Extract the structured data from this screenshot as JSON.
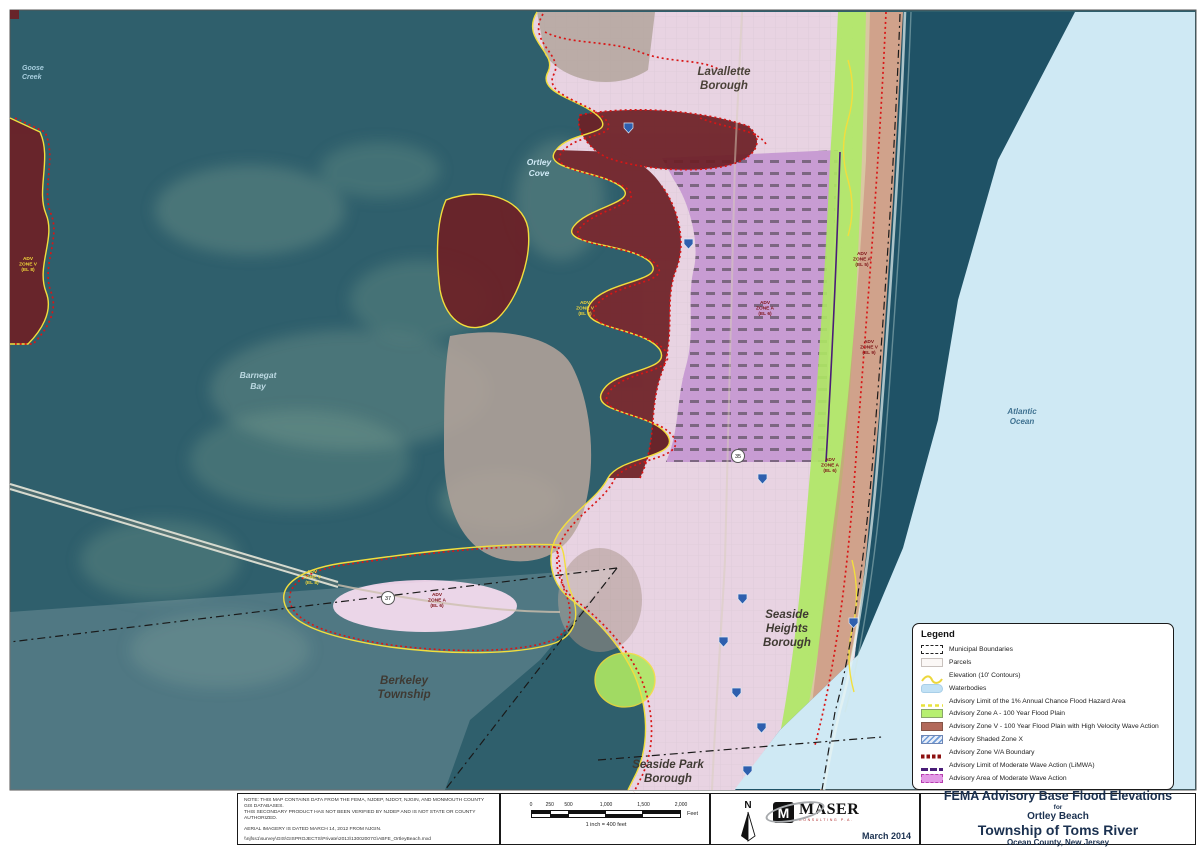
{
  "map": {
    "place_labels": {
      "goose_creek": [
        "Goose",
        "Creek"
      ],
      "lavallette": [
        "Lavallette",
        "Borough"
      ],
      "ortley_cove": [
        "Ortley",
        "Cove"
      ],
      "barnegat_bay": [
        "Barnegat",
        "Bay"
      ],
      "atlantic_ocean": [
        "Atlantic",
        "Ocean"
      ],
      "seaside_heights": [
        "Seaside",
        "Heights",
        "Borough"
      ],
      "berkeley": [
        "Berkeley",
        "Township"
      ],
      "seaside_park": [
        "Seaside Park",
        "Borough"
      ]
    },
    "zone_labels": [
      {
        "lines": [
          "ADV",
          "ZONE V",
          "(EL 8)"
        ]
      },
      {
        "lines": [
          "ADV",
          "ZONE V",
          "(EL 8)"
        ]
      },
      {
        "lines": [
          "ADV",
          "ZONE A",
          "(EL 6)"
        ]
      },
      {
        "lines": [
          "ADV",
          "ZONE A",
          "(EL 5)"
        ]
      },
      {
        "lines": [
          "ADV",
          "ZONE V",
          "(EL 9)"
        ]
      },
      {
        "lines": [
          "ADV",
          "ZONE A",
          "(EL 6)"
        ]
      },
      {
        "lines": [
          "ADV",
          "ZONE V",
          "(EL 8)"
        ]
      },
      {
        "lines": [
          "ADV",
          "ZONE A",
          "(EL 6)"
        ]
      }
    ],
    "route_shields": [
      "37",
      "35"
    ]
  },
  "legend": {
    "title": "Legend",
    "items": [
      {
        "label": "Municipal Boundaries"
      },
      {
        "label": "Parcels"
      },
      {
        "label": "Elevation (10' Contours)"
      },
      {
        "label": "Waterbodies"
      },
      {
        "label": "Advisory Limit of the 1% Annual Chance Flood Hazard Area"
      },
      {
        "label": "Advisory Zone A - 100 Year Flood Plain"
      },
      {
        "label": "Advisory Zone V - 100 Year Flood Plain with High Velocity Wave Action"
      },
      {
        "label": "Advisory Shaded Zone X"
      },
      {
        "label": "Advisory Zone V/A Boundary"
      },
      {
        "label": "Advisory Limit of Moderate Wave Action (LiMWA)"
      },
      {
        "label": "Advisory Area of Moderate Wave Action"
      }
    ]
  },
  "notes": {
    "line1": "NOTE:  THIS MAP CONTAINS DATA FROM THE FEMA, NJDEP, NJDOT, NJGIN, AND MONMOUTH COUNTY GIS DATABASES.",
    "line2": "THIS SECONDARY PRODUCT HAS NOT BEEN VERIFIED BY NJDEP AND IS NOT STATE OR COUNTY AUTHORIZED.",
    "line3": "AERIAL IMAGERY IS DATED MARCH 14, 2012 FROM NJGIN.",
    "line4": "\\\\njfss1\\survey\\GIS\\GISPROJECTS\\Private\\2013\\13002007G\\ABFE_OrtleyBeach.mxd"
  },
  "scalebar": {
    "ticks": [
      "0",
      "250",
      "500",
      "1,000",
      "1,500",
      "2,000"
    ],
    "unit": "Feet",
    "caption": "1 inch = 400 feet"
  },
  "branding": {
    "north_label": "N",
    "logo_mark": "M",
    "logo_text": "MASER",
    "logo_subtext": "CONSULTING P.A.",
    "date": "March 2014"
  },
  "title_block": {
    "line1": "FEMA Advisory Base Flood Elevations",
    "line2": "for",
    "line3": "Ortley Beach",
    "line4": "Township of Toms River",
    "line5": "Ocean County, New Jersey"
  },
  "colors": {
    "bay_water": "#2f5f6c",
    "ocean_flat": "#cfe9f4",
    "zone_a_green": "#b7ef70",
    "zone_v_brown": "#b2695a",
    "zone_v_dark": "#6d2026",
    "mowa_pink": "#e39ae6",
    "contour_yellow": "#f2de3d",
    "va_boundary_red": "#8d1111",
    "limwa_purple": "#4a1d78",
    "title_navy": "#1b3150"
  }
}
